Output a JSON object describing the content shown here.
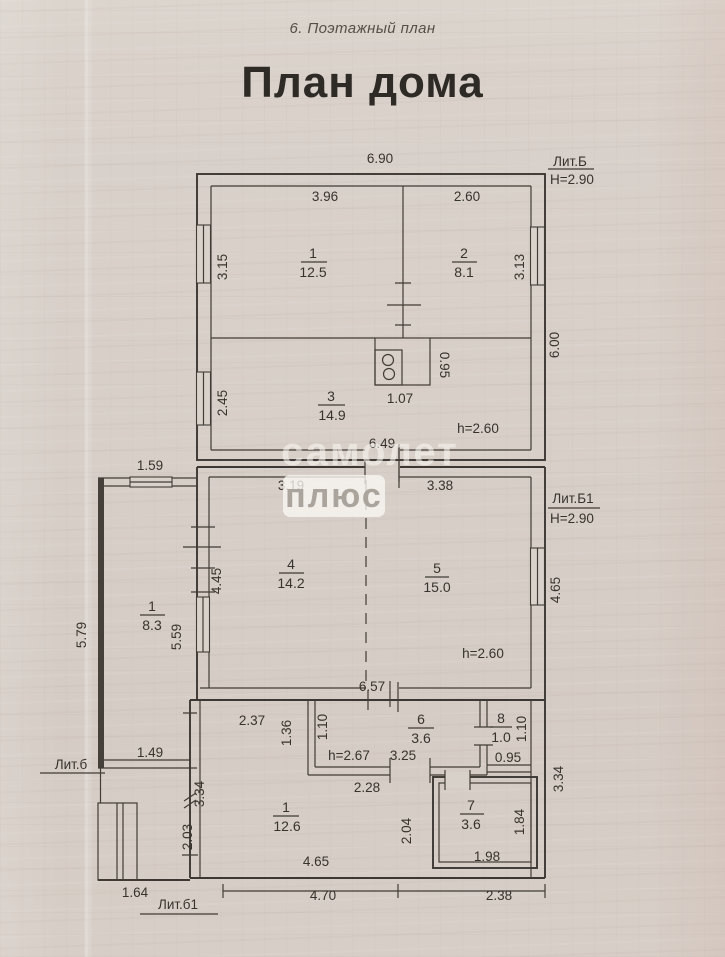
{
  "t": {
    "header": "6. Поэтажный план",
    "title": "План дома",
    "wm1": "самолет",
    "wm2": "плюс"
  },
  "colors": {
    "paper": "#d7cfc8",
    "ink": "#3c3732"
  },
  "top": {
    "lit": "Лит.Б",
    "h": "Н=2.90",
    "w690": "6.90",
    "w396": "3.96",
    "w260": "2.60",
    "v315": "3.15",
    "v313": "3.13",
    "v600": "6.00",
    "v245": "2.45",
    "r1n": "1",
    "r1a": "12.5",
    "r2n": "2",
    "r2a": "8.1",
    "r3n": "3",
    "r3a": "14.9",
    "stw": "1.07",
    "sth": "0.95",
    "ceil": "h=2.60",
    "w649": "6.49"
  },
  "mid": {
    "lit": "Лит.Б1",
    "h": "Н=2.90",
    "w319": "3.19",
    "w338": "3.38",
    "v445": "4.45",
    "v465": "4.65",
    "r4n": "4",
    "r4a": "14.2",
    "r5n": "5",
    "r5a": "15.0",
    "ceil": "h=2.60",
    "w657": "6.57"
  },
  "annex": {
    "lit": "Лит.б",
    "w159": "1.59",
    "v579": "5.79",
    "v559": "5.59",
    "w149": "1.49",
    "rn": "1",
    "ra": "8.3"
  },
  "bot": {
    "lit": "Лит.б1",
    "w237": "2.37",
    "v136": "1.36",
    "v110a": "1.10",
    "r6n": "6",
    "r6a": "3.6",
    "ceil": "h=2.67",
    "w325": "3.25",
    "r8n": "8",
    "r8a": "1.0",
    "v110b": "1.10",
    "w095": "0.95",
    "w228": "2.28",
    "v334r": "3.34",
    "v334l": "3.34",
    "v203": "2.03",
    "r1n": "1",
    "r1a": "12.6",
    "v204": "2.04",
    "r7n": "7",
    "r7a": "3.6",
    "v184": "1.84",
    "w198": "1.98",
    "w465": "4.65",
    "w470": "4.70",
    "w238": "2.38",
    "w164": "1.64"
  }
}
